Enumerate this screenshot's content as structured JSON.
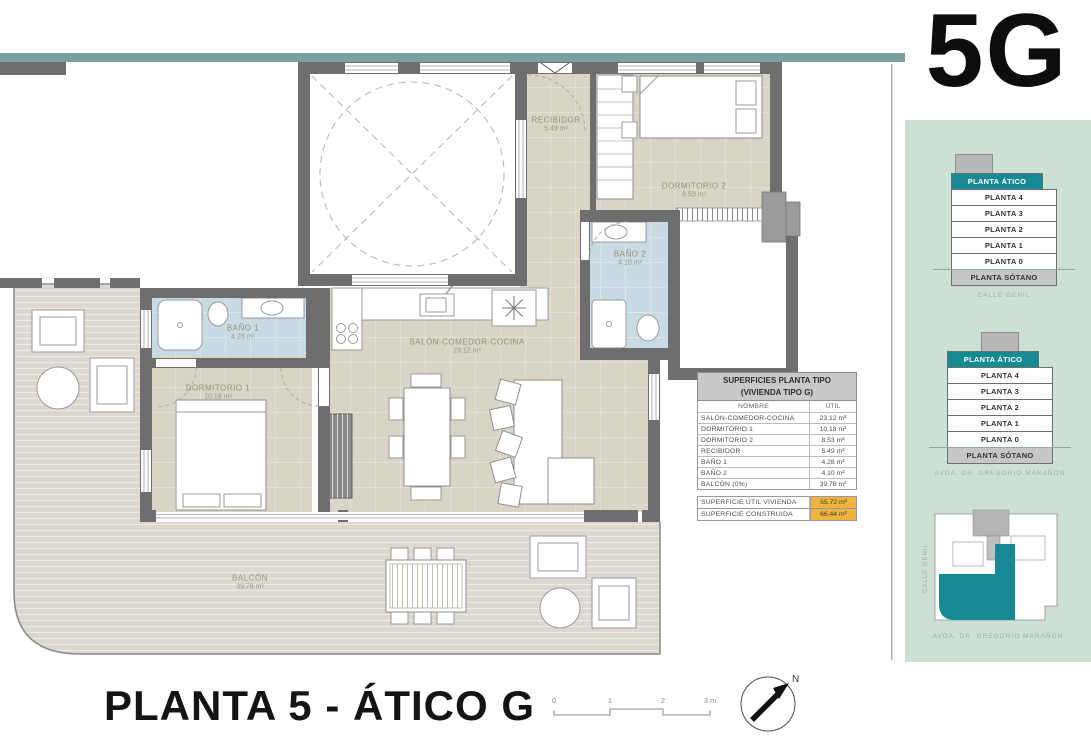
{
  "unit_label": "5G",
  "sheet_title": "PLANTA 5 - ÁTICO G",
  "north_label": "N",
  "scale_bar": {
    "ticks": [
      "0",
      "1",
      "2",
      "3 m"
    ]
  },
  "plan": {
    "labels": [
      {
        "name": "RECIBIDOR",
        "area": "5.49 m²"
      },
      {
        "name": "DORMITORIO 2",
        "area": "8.53 m²"
      },
      {
        "name": "BAÑO 2",
        "area": "4.10 m²"
      },
      {
        "name": "BAÑO 1",
        "area": "4.28 m²"
      },
      {
        "name": "DORMITORIO 1",
        "area": "10.18 m²"
      },
      {
        "name": "SALÓN-COMEDOR-COCINA",
        "area": "23.12 m²"
      },
      {
        "name": "BALCÓN",
        "area": "39.78 m²"
      }
    ]
  },
  "areas_table": {
    "title_line1": "SUPERFICIES PLANTA TIPO",
    "title_line2": "(VIVIENDA TIPO G)",
    "columns": {
      "name": "NOMBRE",
      "util": "ÚTIL"
    },
    "rows": [
      {
        "name": "SALÓN-COMEDOR-COCINA",
        "util": "23.12 m²"
      },
      {
        "name": "DORMITORIO 1",
        "util": "10.18 m²"
      },
      {
        "name": "DORMITORIO 2",
        "util": "8.53 m²"
      },
      {
        "name": "RECIBIDOR",
        "util": "5.49 m²"
      },
      {
        "name": "BAÑO 1",
        "util": "4.28 m²"
      },
      {
        "name": "BAÑO 2",
        "util": "4.10 m²"
      },
      {
        "name": "BALCÓN (0%)",
        "util": "39.78 m²"
      }
    ],
    "summary": [
      {
        "name": "SUPERFICIE ÚTIL VIVIENDA",
        "value": "55.72 m²"
      },
      {
        "name": "SUPERFICIE CONSTRUIDA",
        "value": "66.44 m²"
      }
    ]
  },
  "side_panel": {
    "stacks": [
      {
        "floors": [
          "PLANTA ÁTICO",
          "PLANTA 4",
          "PLANTA 3",
          "PLANTA 2",
          "PLANTA 1",
          "PLANTA 0",
          "PLANTA SÓTANO"
        ],
        "caption": "CALLE GENIL"
      },
      {
        "floors": [
          "PLANTA ÁTICO",
          "PLANTA 4",
          "PLANTA 3",
          "PLANTA 2",
          "PLANTA 1",
          "PLANTA 0",
          "PLANTA SÓTANO"
        ],
        "caption": "AVDA. DR. GREGORIO MARAÑÓN"
      }
    ],
    "site_plan": {
      "street_left": "CALLE GENIL",
      "street_bottom": "AVDA. DR. GREGORIO MARAÑÓN"
    }
  },
  "colors": {
    "accent_teal": "#168a92",
    "top_bar": "#7ba0a2",
    "panel_green": "#cde0d5",
    "highlight_orange": "#f0b43c",
    "wall_gray": "#6e6e6e",
    "floor_beige": "#d8d4c6",
    "bath_blue": "#c8dae3",
    "balcony_gray": "#dcd8d0"
  }
}
